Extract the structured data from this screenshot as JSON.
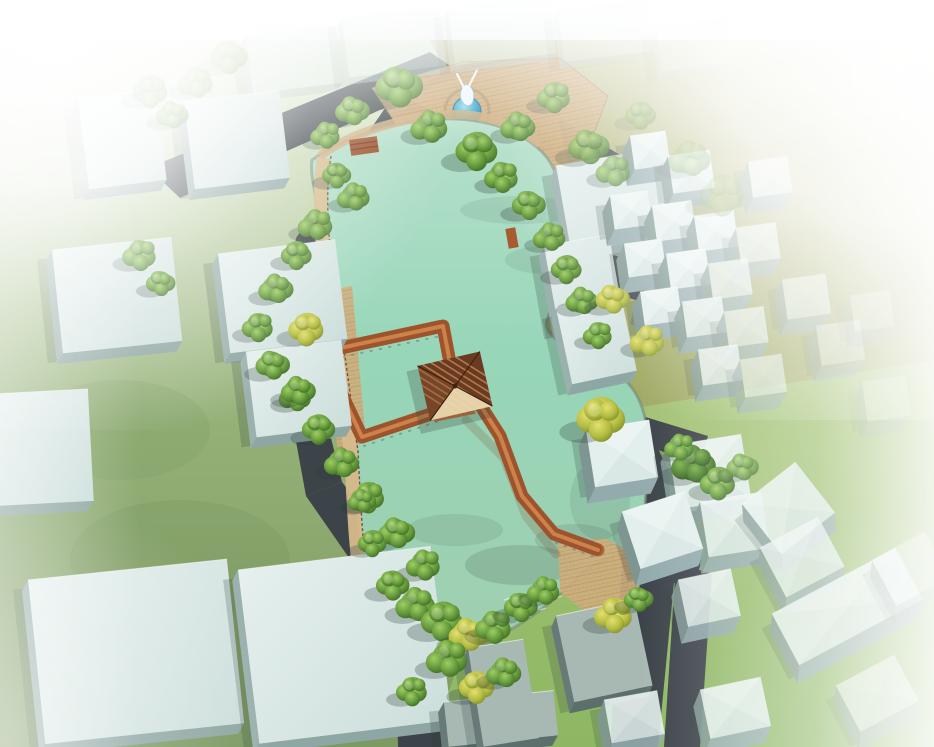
{
  "meta": {
    "title": "Aerial 3D architectural rendering: pond park with zigzag wooden bridge and pavilion surrounded by village massing blocks",
    "width_px": 934,
    "height_px": 747,
    "visible_text": []
  },
  "scene": {
    "view": "bird's-eye perspective massing render with white haze vignette at edges",
    "elements": [
      {
        "name": "upper-pond",
        "desc": "large irregular pond with pale teal-green water, north of bridge"
      },
      {
        "name": "lower-pond",
        "desc": "second pond south of the bridge, with tree-lined wavy south shore"
      },
      {
        "name": "bridge-loop",
        "desc": "rectangular wooden boardwalk loop over the water, orange-brown deck with dark lattice railings"
      },
      {
        "name": "zigzag-bridge",
        "desc": "zigzag boardwalk running from the pavilion to the southeast paved landing"
      },
      {
        "name": "bridge-pavilion",
        "desc": "square pavilion with dark striped pyramidal roof and light lower face at the bridge junction"
      },
      {
        "name": "fountain-statue-plaza",
        "desc": "tan paved plaza at top-center with small round blue fountain pool and white abstract sculpture"
      },
      {
        "name": "shore-pavilion",
        "desc": "small brown timber shelter on the north shore"
      },
      {
        "name": "promenade",
        "desc": "tan brick walkway with dark railing along the west shore"
      },
      {
        "name": "buildings",
        "desc": "flat-roofed pale blue-grey massing blocks; large slabs west/south, cluster of small cubes east",
        "count": 50
      },
      {
        "name": "trees",
        "desc": "round green and yellow-green trees lining streets, plaza and shores",
        "count": 61
      },
      {
        "name": "roads",
        "desc": "dark slate asphalt streets between the blocks"
      },
      {
        "name": "grass",
        "desc": "hazy green lawn west, olive-yellow field northeast, brighter green field southeast"
      },
      {
        "name": "haze-overlay",
        "desc": "white atmospheric fade strongest at top-left, top and right edges"
      }
    ]
  },
  "palette": {
    "haze_white": "#ffffff",
    "water_light": "#b7e0cc",
    "water_mid": "#97d6b8",
    "water_deep": "#a0ceb0",
    "grass_hazy": "#e3edd3",
    "grass_left": "#94b077",
    "grass_olive": "#a6ac69",
    "grass_bright": "#92b866",
    "road_dark": "#3c4349",
    "road_light": "#5d646b",
    "roof_top": "#dceae7",
    "roof_edge": "#f2f8f6",
    "roof_side_south": "#8fa7a4",
    "roof_side_west": "#7d9691",
    "roof_dark": "#a8b8b3",
    "bridge_deck": "#b4663a",
    "bridge_deck_light": "#d98c52",
    "bridge_rail": "#7a3a1c",
    "pavilion_roof": "#6b3a22",
    "pavilion_stripe": "#c89058",
    "pavilion_face": "#ecd9b0",
    "paving_tan": "#cfae7e",
    "paving_joint": "#b08a56",
    "promenade_tan": "#d7ba8c",
    "tree_green_hi": "#9ecf63",
    "tree_green": "#5f9338",
    "tree_green_dark": "#3f6b28",
    "tree_yellow": "#b4bd42",
    "statue_white": "#eef8ff",
    "fountain_blue": "#2e9cc8",
    "shadow": "#2e4038"
  }
}
